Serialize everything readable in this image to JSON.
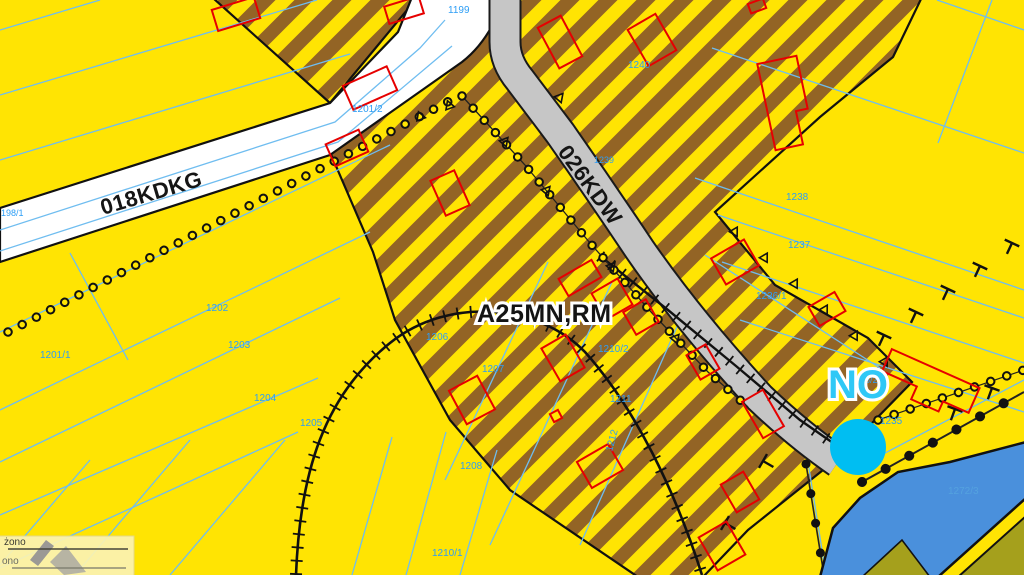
{
  "map": {
    "zone_label": "A25MN,RM",
    "marker_label": "NO",
    "roads": {
      "main": "018KDKG",
      "side": "026KDW"
    },
    "parcels": {
      "p1198_1": "198/1",
      "p1199": "1199",
      "p1201_1": "1201/1",
      "p1201_2": "1201/2",
      "p1202": "1202",
      "p1203": "1203",
      "p1204": "1204",
      "p1205": "1205",
      "p1206": "1206",
      "p1207": "1207",
      "p1208": "1208",
      "p1210_1": "1210/1",
      "p1210_2": "1210/2",
      "p1211": "1211",
      "p1212": "1212",
      "p1235": "1235",
      "p1236_1": "1236/1",
      "p1236_2": "1236/2",
      "p1237": "1237",
      "p1238": "1238",
      "p1239": "1239",
      "p1240": "1240",
      "p1272_3": "1272/3"
    },
    "stamp": {
      "line1": "żono",
      "line2": "ono"
    },
    "colors": {
      "background_yellow": "#FFE403",
      "stripe_brown": "#936425",
      "road_main_white": "#FFFFFF",
      "road_side_gray": "#C6C6C6",
      "cadastral_blue": "#6FBDF0",
      "parcel_label_blue": "#2E9EF5",
      "building_red": "#E60000",
      "water_blue": "#4A90DC",
      "forest_olive": "#A5A01C",
      "marker_cyan": "#00BEF2",
      "boundary_black": "#111111"
    }
  }
}
